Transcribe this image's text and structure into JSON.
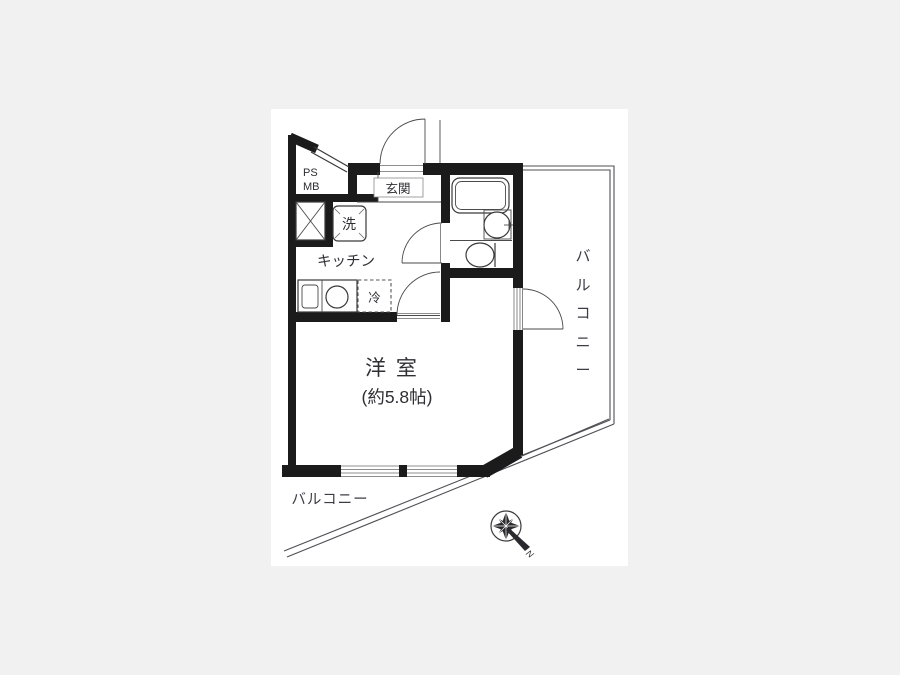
{
  "meta": {
    "type": "apartment-floor-plan",
    "colors": {
      "background": "#f1f1f2",
      "paper": "#ffffff",
      "wall": "#1b1b1b",
      "line": "#3a3a3a",
      "text": "#2e2e33"
    }
  },
  "labels": {
    "ps": "PS",
    "mb": "MB",
    "entrance": "玄関",
    "washer": "洗",
    "kitchen": "キッチン",
    "fridge": "冷",
    "room_name": "洋 室",
    "room_size": "(約5.8帖)",
    "balcony_bottom": "バルコニー",
    "balcony_right_chars": [
      "バ",
      "ル",
      "コ",
      "ニ",
      "ー"
    ],
    "compass_north": "N"
  }
}
